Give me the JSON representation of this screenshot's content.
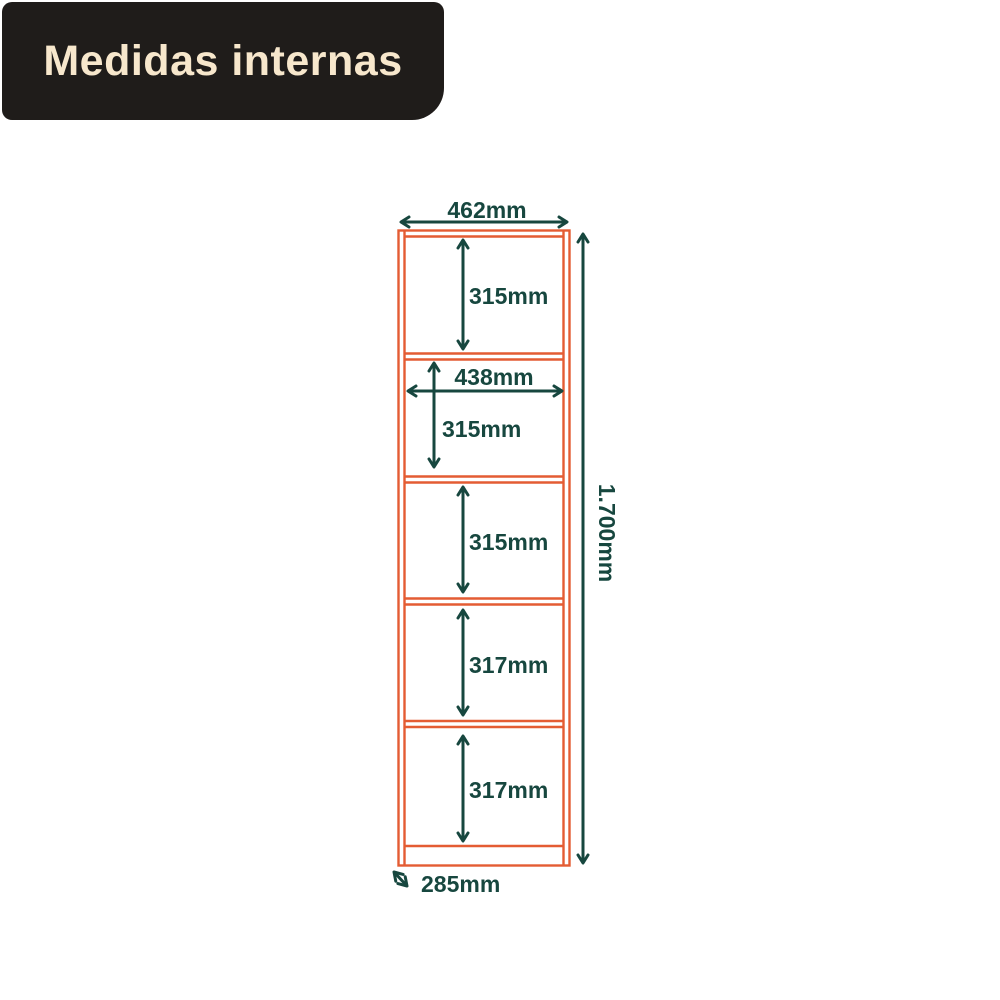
{
  "title": {
    "label": "Medidas internas"
  },
  "colors": {
    "title_background": "#1F1C1A",
    "title_text": "#F7E7CC",
    "furniture_outline": "#E45C33",
    "dimension_annotations": "#17473F",
    "page_background": "#FFFFFF"
  },
  "diagram": {
    "overall": {
      "width": "462mm",
      "height": "1.700mm",
      "depth": "285mm",
      "inner_width": "438mm"
    },
    "compartments": [
      {
        "height": "315mm"
      },
      {
        "height": "315mm"
      },
      {
        "height": "315mm"
      },
      {
        "height": "317mm"
      },
      {
        "height": "317mm"
      }
    ]
  }
}
